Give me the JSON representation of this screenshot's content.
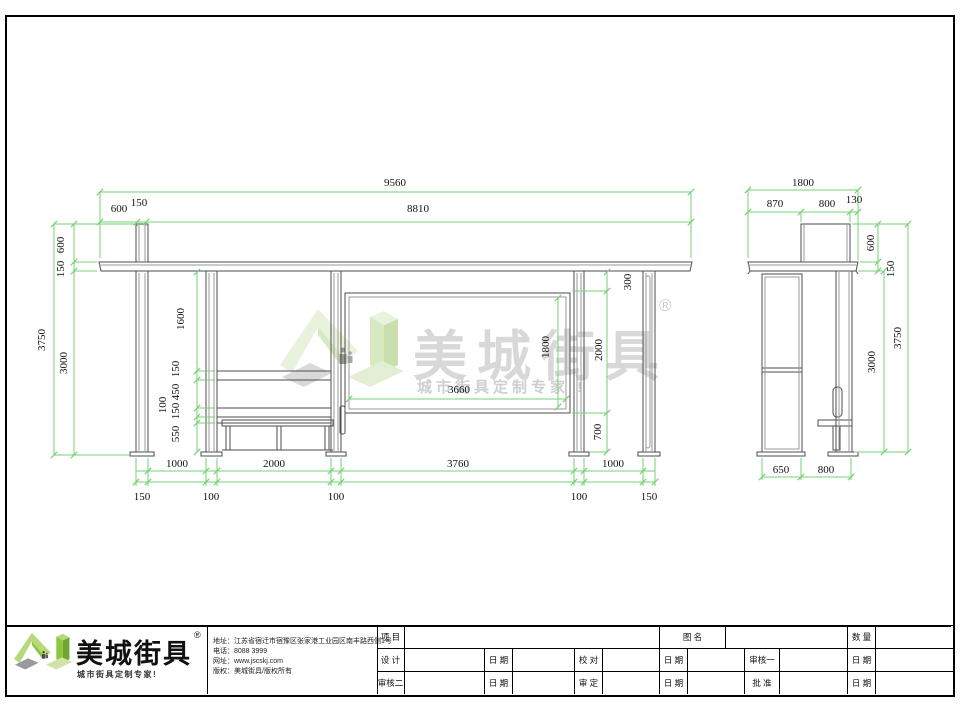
{
  "watermark": {
    "brand": "美城街具",
    "registered": "®",
    "tagline": "城市街具定制专家 !"
  },
  "company": {
    "brand": "美城街具",
    "registered": "®",
    "tagline": "城市街具定制专家!",
    "address": "地址：江苏省宿迁市宿豫区张家港工业园区南丰路西侧1号",
    "phone": "电话：8088 3999",
    "website": "网址：www.jscskj.com",
    "copyright": "版权：美城街具/版权所有"
  },
  "titleblock": {
    "project": "项 目",
    "drawing_name": "图 名",
    "quantity": "数 量",
    "design": "设 计",
    "date": "日 期",
    "proof": "校 对",
    "review1": "审核一",
    "review2": "审核二",
    "approve": "审 定",
    "ratify": "批 准"
  },
  "dims": {
    "front": {
      "total_width": "9560",
      "roof_width": "8810",
      "left_overhang": "600",
      "totem_width": "150",
      "totem_height": "600",
      "roof_thickness": "150",
      "overall_height": "3750",
      "clear_height": "3000",
      "upper_clear": "1600",
      "rail_a": "150",
      "rail_b": "450",
      "rail_c": "150",
      "rail_d": "100",
      "rail_e": "550",
      "panel_width": "3660",
      "panel_height": "1800",
      "panel_top_gap": "300",
      "panel_zone": "2000",
      "panel_bottom_gap": "700",
      "bay1": "1000",
      "bay2": "2000",
      "bay3": "3760",
      "bay4": "1000",
      "col1": "150",
      "col2": "100",
      "col3": "100",
      "col4": "100",
      "col5": "150"
    },
    "side": {
      "total_width": "1800",
      "front_overhang": "870",
      "totem_width": "800",
      "rear_overhang": "130",
      "totem_height": "600",
      "roof_thickness": "150",
      "overall_height": "3750",
      "clear_height": "3000",
      "base_front": "650",
      "base_rear": "800"
    }
  },
  "colors": {
    "dimension_green": "#76d276",
    "logo_green": "#8cc63f",
    "watermark_gray": "#d8d8d8",
    "line_gray": "#4d4d4d"
  }
}
